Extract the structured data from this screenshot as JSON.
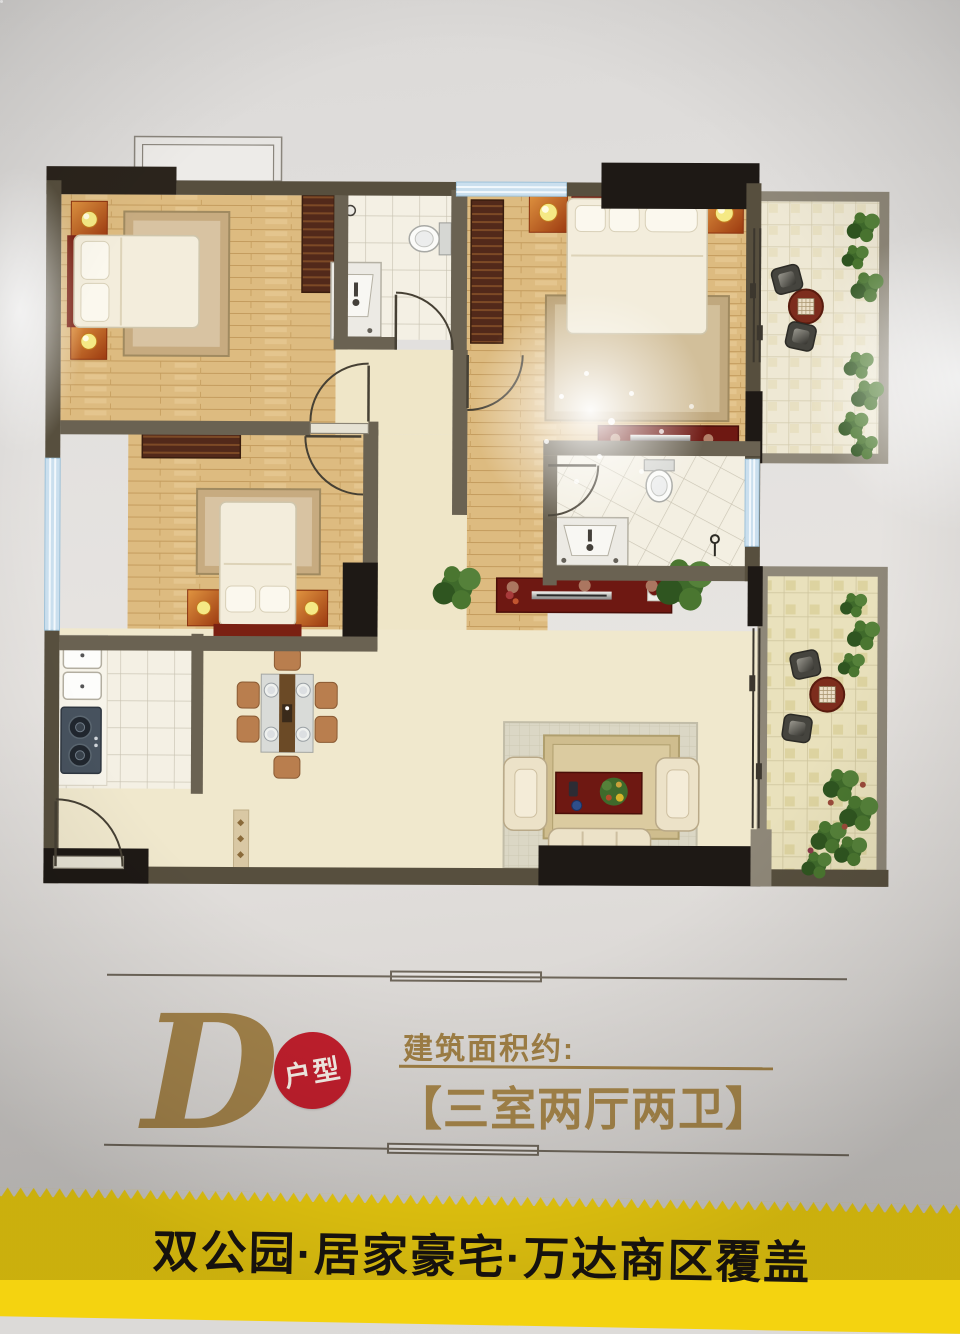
{
  "poster": {
    "unit_letter": "D",
    "unit_badge": "户型",
    "area_label": "建筑面积约:",
    "layout_text": "【三室两厅两卫】",
    "banner_text": "双公园·居家豪宅·万达商区覆盖",
    "colors": {
      "gold": "#a08147",
      "badge_red": "#c11f2d",
      "banner_yellow": "#f4d310",
      "banner_text_color": "#1a1510",
      "wall_dark": "#574f3e",
      "wall_black": "#201b15",
      "balcony_wall": "#8e8778",
      "wood_floor": "#ddbb80",
      "tile_floor": "#f4f0e4",
      "living_floor": "#f0e8cd",
      "headboard_red": "#7a2012",
      "nightstand_orange": "#c4581d",
      "plant_green": "#3f6a2b",
      "window_blue": "#cadfee"
    }
  }
}
